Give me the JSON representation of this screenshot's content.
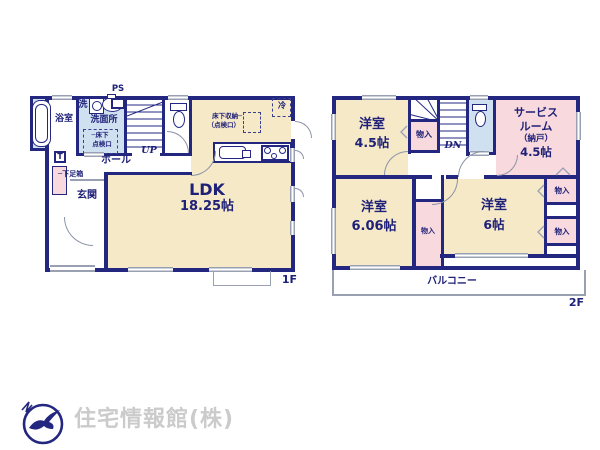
{
  "colors": {
    "wall_navy": "#232780",
    "text_navy": "#1f2178",
    "room_cream": "#f6e9c8",
    "room_pink": "#f8d9dd",
    "room_blue": "#cfe0f1",
    "line_gray": "#98a0b2",
    "footer_gray": "#cbcbcb"
  },
  "floor1": {
    "floor_label": "1F",
    "labels": {
      "ps": "PS",
      "bathroom": "浴室",
      "washer": "洗",
      "washroom": "洗面所",
      "inspection1": "─床下",
      "inspection2": "点検口",
      "up": "UP",
      "hall": "ホール",
      "t": "T",
      "shoebox": "─下足箱",
      "entrance": "玄関",
      "ldk": "LDK",
      "ldk_size": "18.25帖",
      "fridge": "冷",
      "storage1": "床下収納─",
      "storage2": "（点検口）"
    }
  },
  "floor2": {
    "floor_label": "2F",
    "labels": {
      "room45": "洋室",
      "room45_size": "4.5帖",
      "closet_a": "物入",
      "dn": "DN",
      "service1": "サービス",
      "service2": "ルーム",
      "service3": "（納戸）",
      "service4": "4.5帖",
      "closet_d": "物入",
      "closet_e": "物入",
      "room606": "洋室",
      "room606_size": "6.06帖",
      "closet_c": "物入",
      "room6": "洋室",
      "room6_size": "6帖",
      "balcony": "バルコニー"
    }
  },
  "footer": {
    "company": "住宅情報館(株)"
  }
}
